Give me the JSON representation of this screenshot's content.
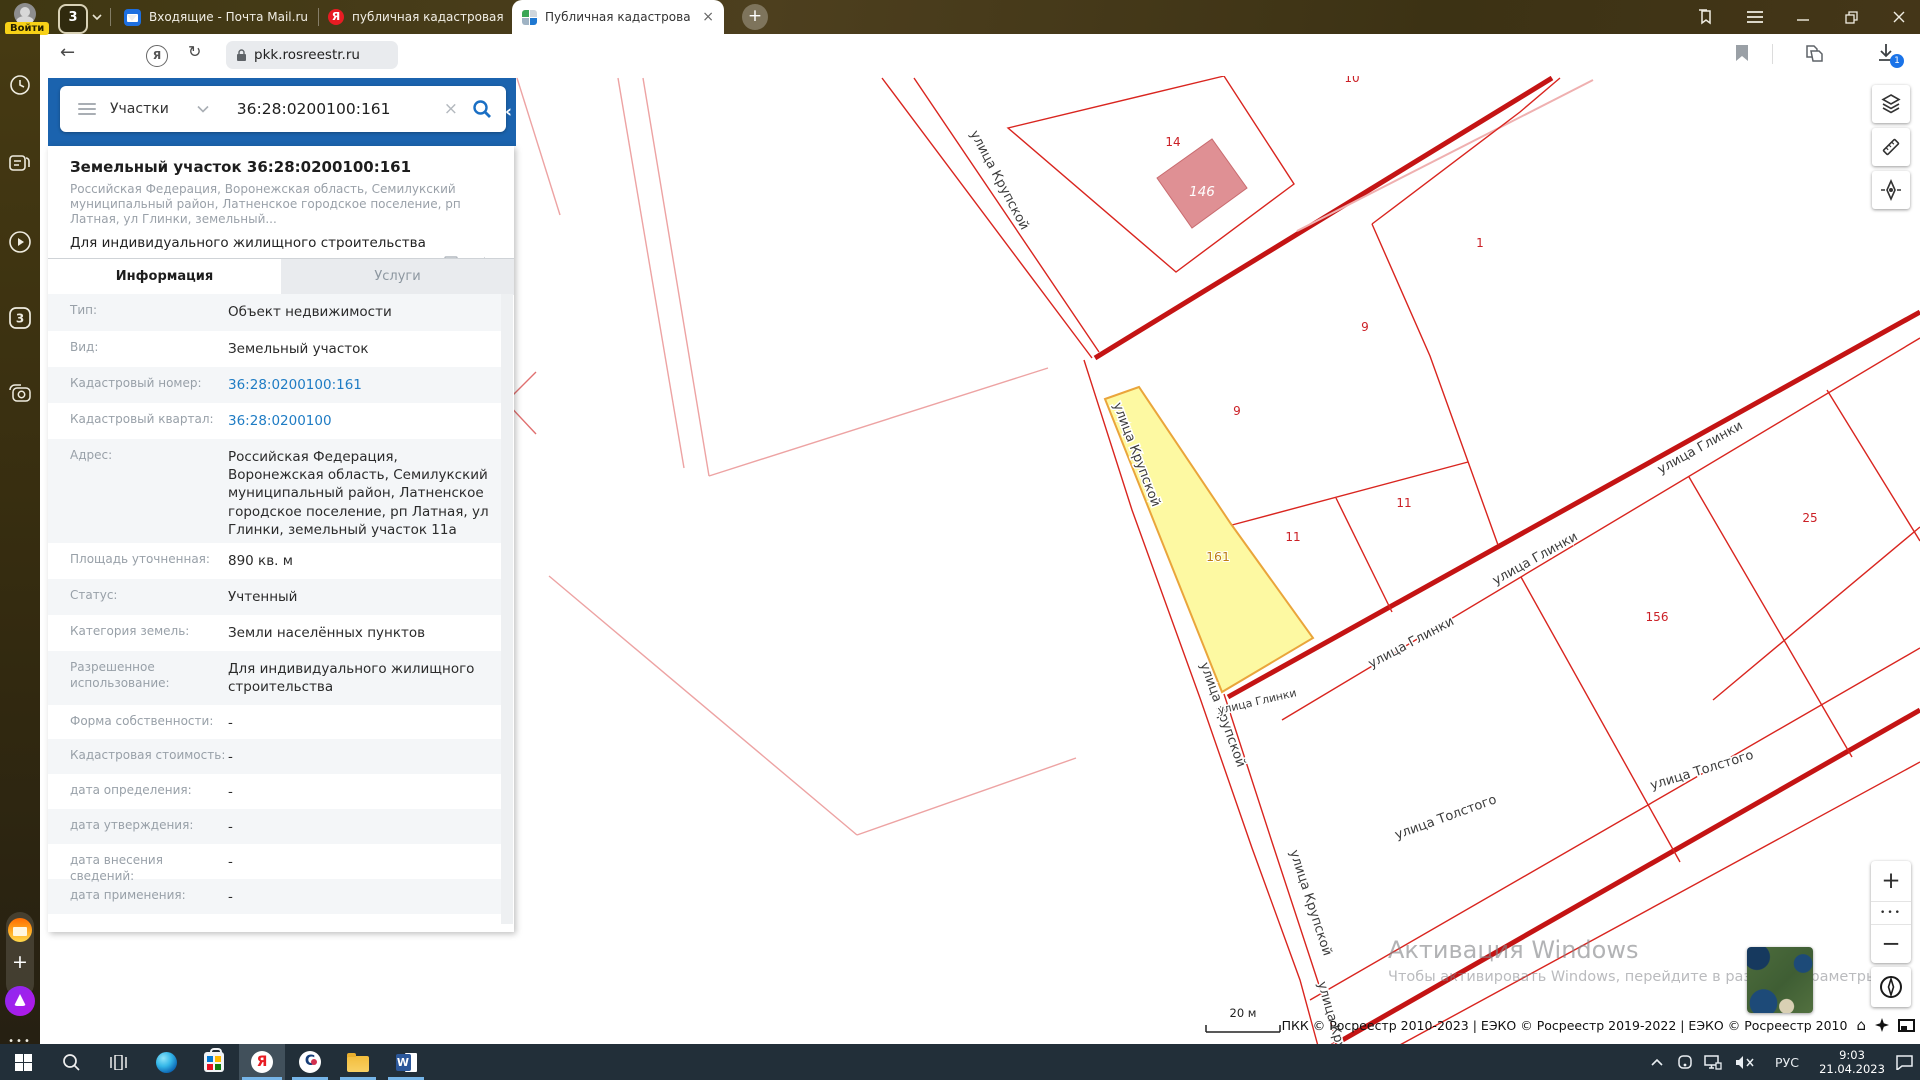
{
  "browser": {
    "login_badge": "Войти",
    "tab_counter": "3",
    "tabs": [
      {
        "title": "Входящие - Почта Mail.ru"
      },
      {
        "title": "публичная кадастровая ка"
      },
      {
        "title": "Публичная кадастрова"
      }
    ],
    "url": "pkk.rosreestr.ru",
    "page_title": "Публичная кадастровая карта",
    "download_badge": "1"
  },
  "glyphs": {
    "back": "←",
    "reload": "↻",
    "close_tab": "×",
    "new_tab": "+",
    "collapse": "‹",
    "clear": "×",
    "star": "☆",
    "home": "⌂",
    "yandex": "Я",
    "word": "W",
    "contour": "C",
    "sidebar_tabs": "3",
    "more_dots": "•••"
  },
  "search": {
    "category": "Участки",
    "query": "36:28:0200100:161"
  },
  "result_card": {
    "title": "Земельный участок 36:28:0200100:161",
    "subtitle": "Российская Федерация, Воронежская область, Семилукский муниципальный район, Латненское городское поселение, рп Латная, ул Глинки, земельный...",
    "usage": "Для индивидуального жилищного строительства",
    "link_zu": "План ЗУ →",
    "link_kk": "План КК →"
  },
  "panel_tabs": {
    "info": "Информация",
    "services": "Услуги"
  },
  "info_rows": [
    {
      "label": "Тип:",
      "value": "Объект недвижимости"
    },
    {
      "label": "Вид:",
      "value": "Земельный участок"
    },
    {
      "label": "Кадастровый номер:",
      "value": "36:28:0200100:161"
    },
    {
      "label": "Кадастровый квартал:",
      "value": "36:28:0200100"
    },
    {
      "label": "Адрес:",
      "value": "Российская Федерация, Воронежская область, Семилукский муниципальный район, Латненское городское поселение, рп Латная, ул Глинки, земельный участок 11а"
    },
    {
      "label": "Площадь уточненная:",
      "value": "890 кв. м"
    },
    {
      "label": "Статус:",
      "value": "Учтенный"
    },
    {
      "label": "Категория земель:",
      "value": "Земли населённых пунктов"
    },
    {
      "label": "Разрешенное использование:",
      "value": "Для индивидуального жилищного строительства"
    },
    {
      "label": "Форма собственности:",
      "value": "-"
    },
    {
      "label": "Кадастровая стоимость:",
      "value": "-"
    },
    {
      "label": "дата определения:",
      "value": "-"
    },
    {
      "label": "дата утверждения:",
      "value": "-"
    },
    {
      "label": "дата внесения сведений:",
      "value": "-"
    },
    {
      "label": "дата применения:",
      "value": "-"
    }
  ],
  "map": {
    "street_labels": [
      "улица Крупской",
      "улица Крупской",
      "улица Крупской",
      "улица Крупской",
      "улица Крупской",
      "улица Глинки",
      "улица Глинки",
      "улица Глинки",
      "улица Глинки",
      "улица Толстого",
      "улица Толстого"
    ],
    "parcel_numbers": [
      "14",
      "1",
      "9",
      "9",
      "11",
      "11",
      "25",
      "156",
      "10"
    ],
    "building_number": "146",
    "selected_parcel_number": "161",
    "scale_label": "20 м",
    "attribution": "ПКК © Росреестр 2010-2023 | ЕЭКО © Росреестр 2019-2022 | ЕЭКО © Росреестр 2010",
    "watermark_title": "Активация Windows",
    "watermark_subtitle": "Чтобы активировать Windows, перейдите в раздел \"Параметры\".",
    "colors": {
      "parcel_line": "#d9251f",
      "road": "#c41414",
      "selected_fill": "#fdf9a2",
      "selected_stroke": "#eaa53b"
    }
  },
  "map_controls": {
    "zoom_in": "+",
    "zoom_out": "−",
    "more": "•••"
  },
  "taskbar": {
    "language": "РУС",
    "time": "9:03",
    "date": "21.04.2023"
  }
}
